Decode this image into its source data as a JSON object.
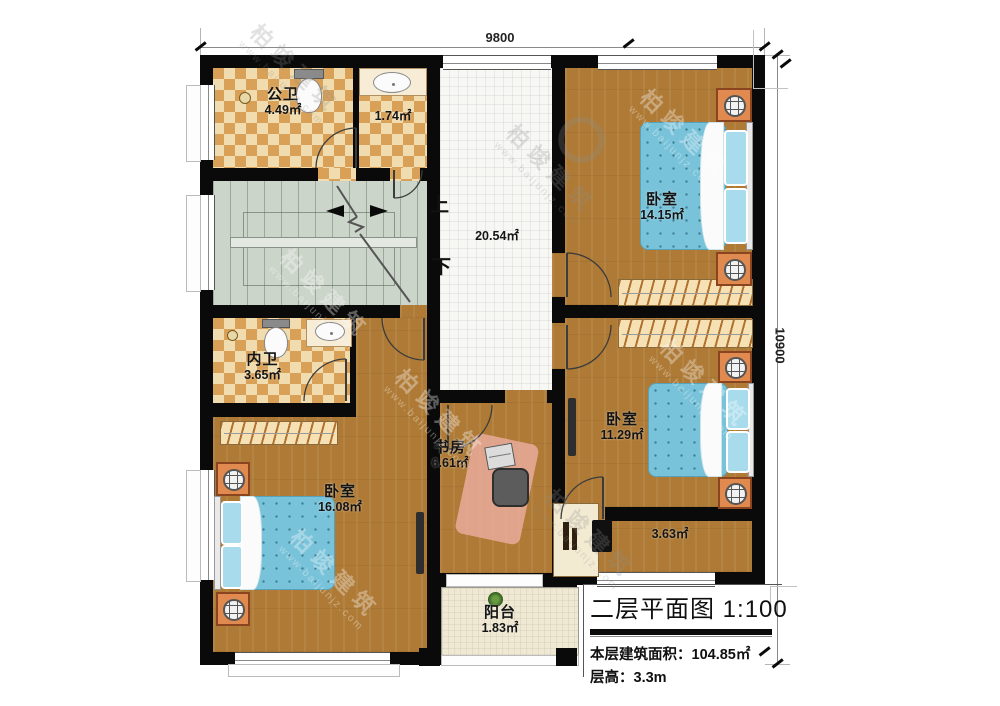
{
  "dimensions": {
    "width_label": "9800",
    "height_label": "10900"
  },
  "title_block": {
    "title": "二层平面图",
    "scale": "1:100",
    "floor_area_label": "本层建筑面积：",
    "floor_area_value": "104.85㎡",
    "floor_height_label": "层高：",
    "floor_height_value": "3.3m"
  },
  "stair": {
    "up_label": "上",
    "down_label": "下"
  },
  "rooms": [
    {
      "id": "public-bath",
      "name": "公卫",
      "area": "4.49㎡"
    },
    {
      "id": "shower-room",
      "name": "",
      "area": "1.74㎡"
    },
    {
      "id": "hallway",
      "name": "",
      "area": "20.54㎡"
    },
    {
      "id": "bedroom-top-right",
      "name": "卧室",
      "area": "14.15㎡"
    },
    {
      "id": "private-bath",
      "name": "内卫",
      "area": "3.65㎡"
    },
    {
      "id": "bedroom-right",
      "name": "卧室",
      "area": "11.29㎡"
    },
    {
      "id": "study",
      "name": "书房",
      "area": "6.61㎡"
    },
    {
      "id": "bedroom-left",
      "name": "卧室",
      "area": "16.08㎡"
    },
    {
      "id": "corridor",
      "name": "",
      "area": "3.63㎡"
    },
    {
      "id": "balcony",
      "name": "阳台",
      "area": "1.83㎡"
    }
  ],
  "watermark": {
    "brand": "柏竣建筑",
    "url": "www.baijunjz.com"
  },
  "colors": {
    "wall": "#0a0a0a",
    "wood": "#ae7a35",
    "tile_checker": "#d9a157",
    "stair": "#ccd5ca",
    "bed": "#79c3da",
    "nightstand": "#e08a50"
  }
}
